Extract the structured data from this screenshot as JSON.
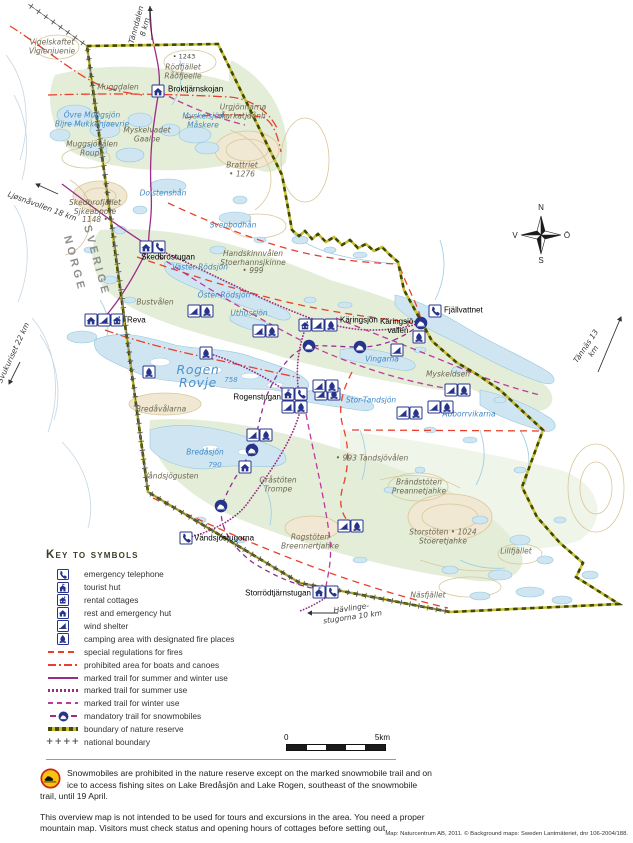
{
  "compass": {
    "n": "N",
    "e": "Ö",
    "s": "S",
    "w": "V"
  },
  "scalebar": {
    "start": "0",
    "end": "5km"
  },
  "legend": {
    "title": "Key to symbols",
    "items": [
      {
        "swatch": "phone",
        "label": "emergency telephone"
      },
      {
        "swatch": "hut",
        "label": "tourist hut"
      },
      {
        "swatch": "cottage",
        "label": "rental cottages"
      },
      {
        "swatch": "resthut",
        "label": "rest and emergency hut"
      },
      {
        "swatch": "wind",
        "label": "wind shelter"
      },
      {
        "swatch": "camp",
        "label": "camping area with designated fire places"
      },
      {
        "swatch": "red-dash",
        "label": "special regulations for fires"
      },
      {
        "swatch": "red-dashdot",
        "label": "prohibited area for boats and canoes"
      },
      {
        "swatch": "purple-solid",
        "label": "marked trail for summer and winter use"
      },
      {
        "swatch": "purple-dot",
        "label": "marked trail for summer use"
      },
      {
        "swatch": "purple-dash",
        "label": "marked trail for winter use"
      },
      {
        "swatch": "sled-trail",
        "label": "mandatory trail for snowmobiles"
      },
      {
        "swatch": "reserve",
        "label": "boundary of nature reserve"
      },
      {
        "swatch": "national",
        "label": "national boundary",
        "swatch_text": "++++"
      }
    ]
  },
  "notes": {
    "warning": "Snowmobiles are prohibited in the nature reserve except on the marked snowmobile trail and on ice to access fishing sites on Lake Bredåsjön and Lake Rogen, southeast of the snowmobile trail, until 19 April.",
    "overview": "This overview map is not intended to be used for tours and excursions in the area. You need a proper mountain map. Visitors must check status and opening hours of cottages before setting out."
  },
  "attribution": "Map: Naturcentrum AB, 2011. © Background maps: Sweden Lantmäteriet, dnr 106-2004/188.",
  "map": {
    "colors": {
      "icon_navy": "#27348b",
      "trail_purple": "#9c2d87",
      "regulation_red": "#e8402a",
      "reserve_olive": "#c6ba33",
      "lake_blue": "#cfe6f2",
      "lake_text": "#3f87c4"
    },
    "labels": [
      {
        "t": "Vigelskaftet\nViglenjuenie",
        "x": 52,
        "y": 47,
        "c": "terr"
      },
      {
        "t": "Tänndalen\n8 km",
        "x": 141,
        "y": 26,
        "c": "ext",
        "r": -75
      },
      {
        "t": "• 1243",
        "x": 184,
        "y": 57,
        "c": "elev"
      },
      {
        "t": "Rödfjället\nRåðfjeelle",
        "x": 183,
        "y": 72,
        "c": "terr"
      },
      {
        "t": "Muggdalen",
        "x": 118,
        "y": 88,
        "c": "terr"
      },
      {
        "t": "Broktjärnskojan",
        "x": 168,
        "y": 90,
        "c": "hut",
        "a": "l"
      },
      {
        "t": "Övre Muggsjön\nBijre Mukkenjaevrie",
        "x": 92,
        "y": 120,
        "c": "lake"
      },
      {
        "t": "Urgjönnarna\nÅarkatjåånh",
        "x": 243,
        "y": 112,
        "c": "terr"
      },
      {
        "t": "Myskelsjön\nMåskere",
        "x": 203,
        "y": 121,
        "c": "lake"
      },
      {
        "t": "Myskelvadet\nGaaloe",
        "x": 147,
        "y": 135,
        "c": "terr"
      },
      {
        "t": "Muggsjövålen\nRoupe",
        "x": 92,
        "y": 149,
        "c": "terr"
      },
      {
        "t": "Brattriet\n• 1276",
        "x": 242,
        "y": 170,
        "c": "terr"
      },
      {
        "t": "Ljøsnåvollen 18 km",
        "x": 42,
        "y": 207,
        "c": "ext",
        "r": 20
      },
      {
        "t": "Dolstenshån",
        "x": 163,
        "y": 194,
        "c": "lake"
      },
      {
        "t": "Skedbrofjället\nSjkeabpore\n1148 •",
        "x": 95,
        "y": 212,
        "c": "terr"
      },
      {
        "t": "Svenbodhån",
        "x": 233,
        "y": 226,
        "c": "lake"
      },
      {
        "t": "SVERIGE",
        "x": 96,
        "y": 261,
        "c": "border",
        "r": 75
      },
      {
        "t": "NORGE",
        "x": 74,
        "y": 264,
        "c": "border",
        "r": 75
      },
      {
        "t": "Skedbrostugan",
        "x": 168,
        "y": 258,
        "c": "hut"
      },
      {
        "t": "Handskinnvålen\nStoerhannsjkinne\n• 999",
        "x": 253,
        "y": 263,
        "c": "terr"
      },
      {
        "t": "Väster-Rödsjön",
        "x": 200,
        "y": 268,
        "c": "lake"
      },
      {
        "t": "Öster-Rödsjön",
        "x": 224,
        "y": 296,
        "c": "lake"
      },
      {
        "t": "Uthussjön",
        "x": 249,
        "y": 314,
        "c": "lake"
      },
      {
        "t": "Bustvålen",
        "x": 155,
        "y": 303,
        "c": "terr"
      },
      {
        "t": "Reva",
        "x": 127,
        "y": 321,
        "c": "hut",
        "a": "l"
      },
      {
        "t": "Käringsjön",
        "x": 340,
        "y": 321,
        "c": "hut",
        "a": "l"
      },
      {
        "t": "Käringsjö-\nvallen",
        "x": 398,
        "y": 327,
        "c": "hut"
      },
      {
        "t": "Fjällvattnet",
        "x": 444,
        "y": 311,
        "c": "hut",
        "a": "l"
      },
      {
        "t": "Vingarna",
        "x": 382,
        "y": 360,
        "c": "lake"
      },
      {
        "t": "Tännäs 13 km",
        "x": 590,
        "y": 349,
        "c": "ext",
        "r": -56
      },
      {
        "t": "Myskeldsen",
        "x": 448,
        "y": 375,
        "c": "terr"
      },
      {
        "t": "Rogen\nRovje",
        "x": 198,
        "y": 376,
        "c": "biglake"
      },
      {
        "t": "758",
        "x": 231,
        "y": 380,
        "c": "lakeelev"
      },
      {
        "t": "Rogenstugan",
        "x": 281,
        "y": 398,
        "c": "hut",
        "a": "r"
      },
      {
        "t": "Stor-Tandsjön",
        "x": 371,
        "y": 401,
        "c": "lake"
      },
      {
        "t": "Abborrvikarna",
        "x": 469,
        "y": 415,
        "c": "lake"
      },
      {
        "t": "Svukuriset 22 km",
        "x": 14,
        "y": 353,
        "c": "ext",
        "r": -65
      },
      {
        "t": "Bredåvålarna",
        "x": 161,
        "y": 410,
        "c": "terr"
      },
      {
        "t": "Bredåsjön",
        "x": 205,
        "y": 453,
        "c": "lake"
      },
      {
        "t": "790",
        "x": 215,
        "y": 465,
        "c": "lakeelev"
      },
      {
        "t": "• 993 Tandsjövålen",
        "x": 372,
        "y": 459,
        "c": "terr"
      },
      {
        "t": "Våndsjögusten",
        "x": 171,
        "y": 477,
        "c": "terr"
      },
      {
        "t": "Gråstöten\nTrompe",
        "x": 278,
        "y": 485,
        "c": "terr"
      },
      {
        "t": "Brändstöten\nPreannetjahke",
        "x": 419,
        "y": 487,
        "c": "terr"
      },
      {
        "t": "Vändsjöstugorna",
        "x": 194,
        "y": 539,
        "c": "hut",
        "a": "l"
      },
      {
        "t": "Rogstöten\nBreennertjahke",
        "x": 310,
        "y": 542,
        "c": "terr"
      },
      {
        "t": "Storstöten • 1024\nStoeretjahke",
        "x": 443,
        "y": 537,
        "c": "terr"
      },
      {
        "t": "Lillfjället",
        "x": 516,
        "y": 552,
        "c": "terr"
      },
      {
        "t": "Näsfjället",
        "x": 428,
        "y": 596,
        "c": "terr"
      },
      {
        "t": "Storrödtjärnstugan",
        "x": 311,
        "y": 594,
        "c": "hut",
        "a": "r"
      },
      {
        "t": "Hävlinge-\nstugorna 10 km",
        "x": 352,
        "y": 613,
        "c": "ext",
        "r": -8
      }
    ],
    "icons": [
      {
        "t": "resthut",
        "x": 158,
        "y": 91
      },
      {
        "t": "resthut",
        "x": 146,
        "y": 247
      },
      {
        "t": "phone",
        "x": 159,
        "y": 247
      },
      {
        "t": "resthut",
        "x": 91,
        "y": 320
      },
      {
        "t": "wind",
        "x": 104,
        "y": 320
      },
      {
        "t": "cottage",
        "x": 117,
        "y": 320
      },
      {
        "t": "cottage",
        "x": 305,
        "y": 325
      },
      {
        "t": "wind",
        "x": 318,
        "y": 325
      },
      {
        "t": "camp",
        "x": 331,
        "y": 325
      },
      {
        "t": "phone",
        "x": 435,
        "y": 311
      },
      {
        "t": "sled",
        "x": 421,
        "y": 323
      },
      {
        "t": "camp",
        "x": 419,
        "y": 337
      },
      {
        "t": "wind",
        "x": 397,
        "y": 350
      },
      {
        "t": "sled",
        "x": 360,
        "y": 347
      },
      {
        "t": "sled",
        "x": 309,
        "y": 346
      },
      {
        "t": "hut",
        "x": 288,
        "y": 394
      },
      {
        "t": "phone",
        "x": 301,
        "y": 394
      },
      {
        "t": "wind",
        "x": 288,
        "y": 407
      },
      {
        "t": "camp",
        "x": 301,
        "y": 407
      },
      {
        "t": "wind",
        "x": 321,
        "y": 394
      },
      {
        "t": "camp",
        "x": 334,
        "y": 394
      },
      {
        "t": "wind",
        "x": 194,
        "y": 311
      },
      {
        "t": "camp",
        "x": 207,
        "y": 311
      },
      {
        "t": "wind",
        "x": 259,
        "y": 331
      },
      {
        "t": "camp",
        "x": 272,
        "y": 331
      },
      {
        "t": "camp",
        "x": 206,
        "y": 353
      },
      {
        "t": "camp",
        "x": 149,
        "y": 372
      },
      {
        "t": "wind",
        "x": 319,
        "y": 386
      },
      {
        "t": "camp",
        "x": 332,
        "y": 386
      },
      {
        "t": "wind",
        "x": 451,
        "y": 390
      },
      {
        "t": "camp",
        "x": 464,
        "y": 390
      },
      {
        "t": "wind",
        "x": 434,
        "y": 407
      },
      {
        "t": "camp",
        "x": 447,
        "y": 407
      },
      {
        "t": "wind",
        "x": 403,
        "y": 413
      },
      {
        "t": "camp",
        "x": 416,
        "y": 413
      },
      {
        "t": "wind",
        "x": 253,
        "y": 435
      },
      {
        "t": "camp",
        "x": 266,
        "y": 435
      },
      {
        "t": "sled",
        "x": 252,
        "y": 450
      },
      {
        "t": "resthut",
        "x": 245,
        "y": 467
      },
      {
        "t": "sled",
        "x": 221,
        "y": 506
      },
      {
        "t": "phone",
        "x": 186,
        "y": 538
      },
      {
        "t": "wind",
        "x": 344,
        "y": 526
      },
      {
        "t": "camp",
        "x": 357,
        "y": 526
      },
      {
        "t": "hut",
        "x": 319,
        "y": 592
      },
      {
        "t": "phone",
        "x": 332,
        "y": 592
      }
    ]
  }
}
